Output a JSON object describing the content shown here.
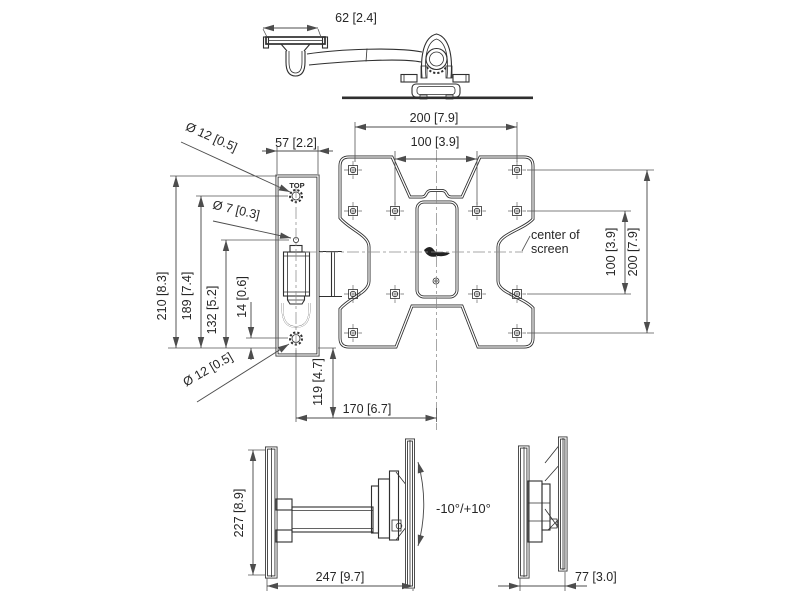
{
  "views": {
    "tilt_range": "-10°/+10°",
    "top": {
      "dims": {
        "depth": "62 [2.4]"
      }
    },
    "front": {
      "dims": {
        "w200": "200 [7.9]",
        "w100": "100 [3.9]",
        "bracket_w": "57 [2.2]",
        "hole_top": "Ø 12 [0.5]",
        "hole_mid": "Ø 7 [0.3]",
        "hole_bottom": "Ø 12 [0.5]",
        "h210": "210 [8.3]",
        "h189": "189 [7.4]",
        "h132": "132 [5.2]",
        "h14": "14 [0.6]",
        "v119": "119 [4.7]",
        "w170": "170 [6.7]",
        "right_h100": "100 [3.9]",
        "right_h200": "200 [7.9]"
      },
      "labels": {
        "top_marking": "TOP",
        "center1": "center of",
        "center2": "screen"
      }
    },
    "side_extended": {
      "dims": {
        "h227": "227 [8.9]",
        "d247": "247 [9.7]"
      }
    },
    "side_folded": {
      "dims": {
        "d77": "77 [3.0]"
      }
    }
  },
  "colors": {
    "background": "#ffffff",
    "drawing_line": "#2f2f2f",
    "dimension_line": "#4d4d4d",
    "text": "#262626"
  }
}
